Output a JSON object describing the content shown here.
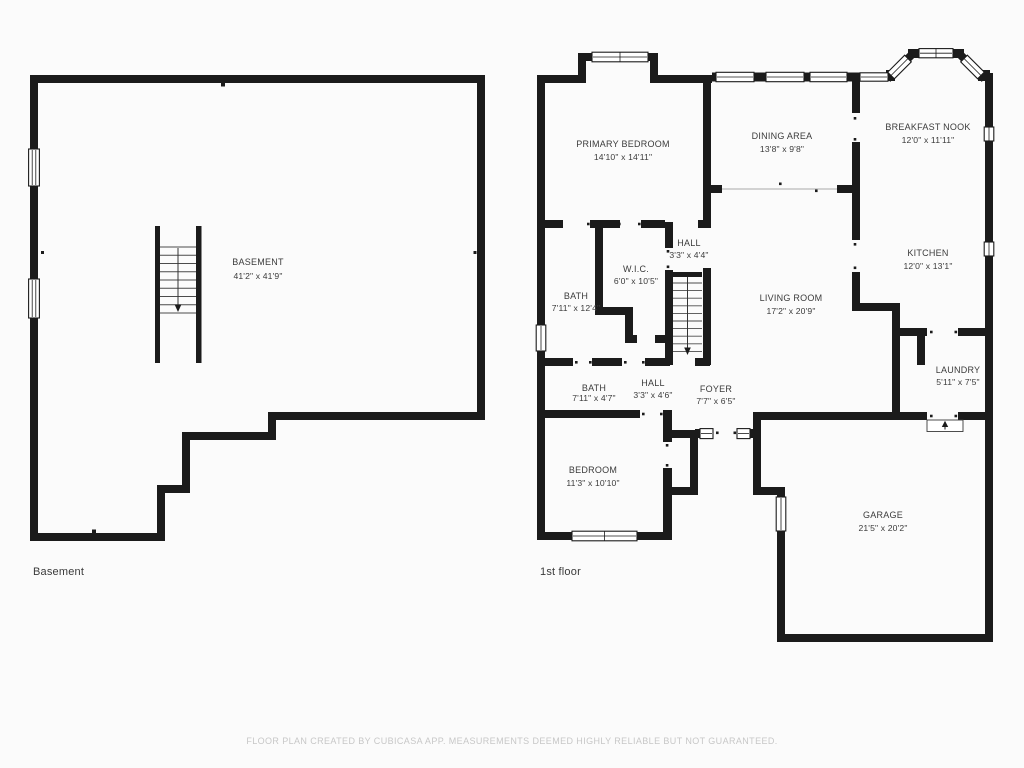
{
  "plans": [
    {
      "id": "basement",
      "floor_label": "Basement",
      "rooms": [
        {
          "name": "BASEMENT",
          "dims": "41'2\" x 41'9\""
        }
      ]
    },
    {
      "id": "first-floor",
      "floor_label": "1st floor",
      "rooms": [
        {
          "name": "PRIMARY BEDROOM",
          "dims": "14'10\" x 14'11\""
        },
        {
          "name": "DINING AREA",
          "dims": "13'8\" x 9'8\""
        },
        {
          "name": "BREAKFAST NOOK",
          "dims": "12'0\" x 11'11\""
        },
        {
          "name": "KITCHEN",
          "dims": "12'0\" x 13'1\""
        },
        {
          "name": "HALL",
          "dims": "3'3\" x 4'4\""
        },
        {
          "name": "W.I.C.",
          "dims": "6'0\" x 10'5\""
        },
        {
          "name": "BATH",
          "dims": "7'11\" x 12'4\""
        },
        {
          "name": "LIVING ROOM",
          "dims": "17'2\" x 20'9\""
        },
        {
          "name": "LAUNDRY",
          "dims": "5'11\" x 7'5\""
        },
        {
          "name": "BATH",
          "dims": "7'11\" x 4'7\""
        },
        {
          "name": "HALL",
          "dims": "3'3\" x 4'6\""
        },
        {
          "name": "FOYER",
          "dims": "7'7\" x 6'5\""
        },
        {
          "name": "BEDROOM",
          "dims": "11'3\" x 10'10\""
        },
        {
          "name": "GARAGE",
          "dims": "21'5\" x 20'2\""
        }
      ]
    }
  ],
  "footer": {
    "disclaimer": "FLOOR PLAN CREATED BY CUBICASA APP. MEASUREMENTS DEEMED HIGHLY RELIABLE BUT NOT GUARANTEED."
  },
  "colors": {
    "wall": "#1b1b1b",
    "label": "#3b3b3b",
    "disclaimer": "#c7c7c7"
  }
}
